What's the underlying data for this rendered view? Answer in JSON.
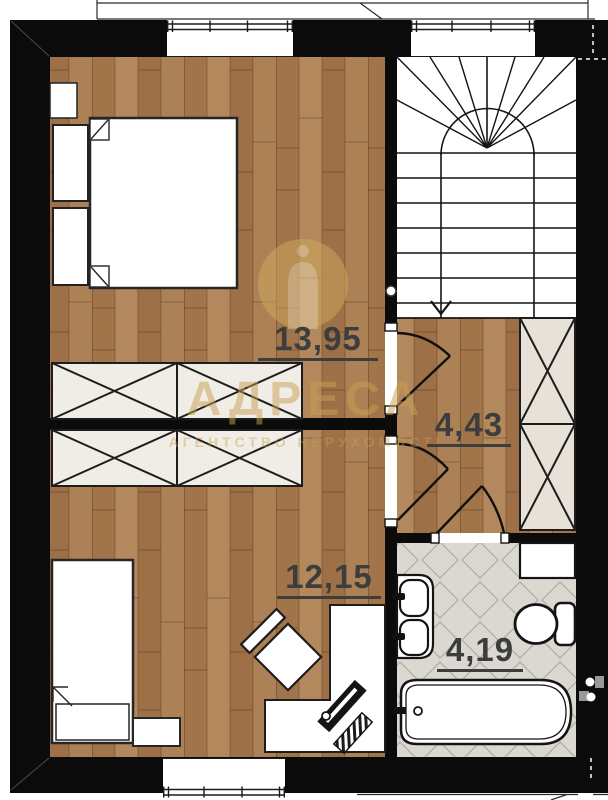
{
  "plan_title": "second-floor-plan",
  "rooms": [
    {
      "id": "bedroom-upper",
      "area_label": "13,95"
    },
    {
      "id": "hallway",
      "area_label": "4,43"
    },
    {
      "id": "bedroom-lower",
      "area_label": "12,15"
    },
    {
      "id": "bathroom",
      "area_label": "4,19"
    }
  ],
  "watermark": {
    "logo_icon": "arch-monument-in-circle-icon",
    "title": "АДРЕСА",
    "subtitle": "АГЕНТСТВО НЕРУХОМОСТІ"
  },
  "colors": {
    "wall": "#0b0b0b",
    "wood": "#a87c52",
    "wood_dark": "#8a6240",
    "tile": "#dbd8d2",
    "tile_line": "#aeaba4",
    "wardrobe_bedroom": "#f0ece6",
    "wardrobe_hall": "#e7e1d7",
    "label_text": "#3d3d3d",
    "watermark_gold": "#c9a050"
  }
}
